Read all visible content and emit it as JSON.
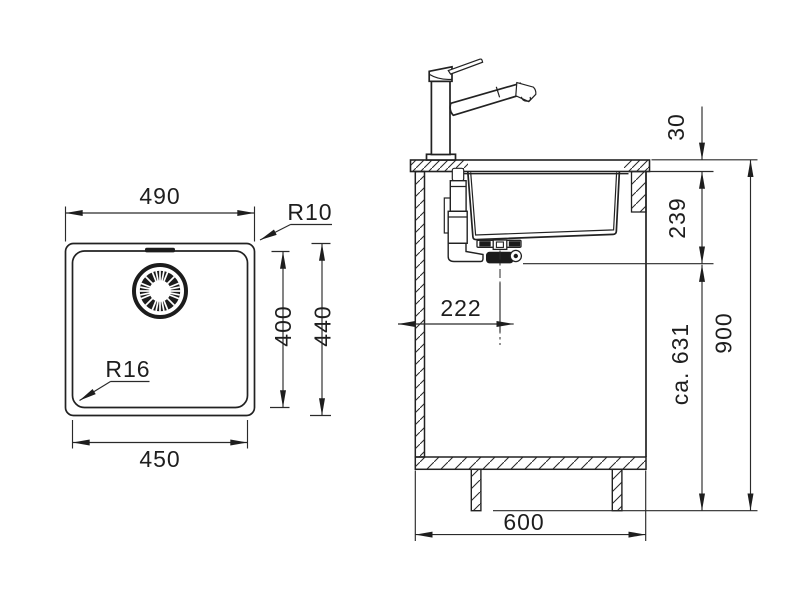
{
  "drawing": {
    "type": "kitchen sink technical installation drawing",
    "units": "mm",
    "plan_view": {
      "dim_outer_width": "490",
      "dim_bowl_width": "450",
      "dim_bowl_depth": "400",
      "dim_outer_depth": "440",
      "radius_outer_corner": "R10",
      "radius_bowl_corner": "R16"
    },
    "section_view": {
      "dim_counter_thickness": "30",
      "dim_bowl_depth_below_counter": "239",
      "dim_drain_offset_from_side": "222",
      "dim_drain_to_floor": "ca. 631",
      "dim_worktop_height": "900",
      "dim_cabinet_width": "600"
    },
    "line_color": "#222222",
    "background_color": "#ffffff"
  }
}
